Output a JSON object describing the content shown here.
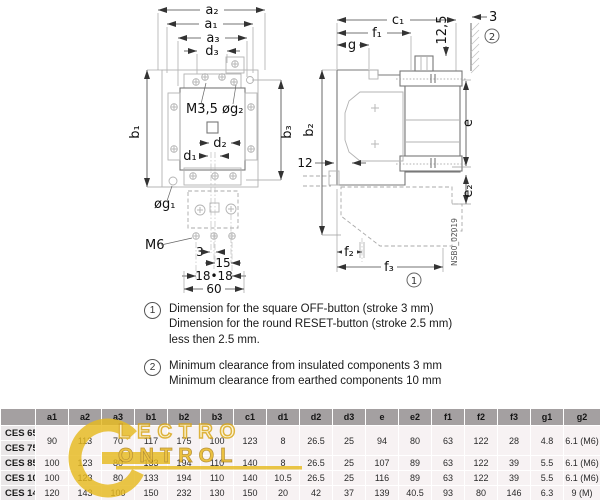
{
  "drawing": {
    "front": {
      "a2": "a₂",
      "a1": "a₁",
      "a3": "a₃",
      "d3": "d₃",
      "b1": "b₁",
      "b3": "b₃",
      "m35": "M3,5 øg₂",
      "d2": "d₂",
      "d1": "d₁",
      "og1": "øg₁",
      "m6": "M6",
      "dim3": "3",
      "dim15": "15",
      "dim1818": "18•18",
      "dim60": "60"
    },
    "side": {
      "c1": "c₁",
      "f1": "f₁",
      "g": "g",
      "dim125": "12,5",
      "dim3": "3",
      "b2": "b₂",
      "dim12": "12",
      "e": "e",
      "e2": "e₂",
      "f2": "f₂",
      "f3": "f₃",
      "code": "NSB0_02019",
      "callout1": "1",
      "callout2": "2"
    }
  },
  "notes": [
    {
      "num": "1",
      "lines": [
        "Dimension for the square OFF-button (stroke 3 mm)",
        "Dimension for the round RESET-button (stroke 2.5 mm)",
        "less then 2.5 mm."
      ]
    },
    {
      "num": "2",
      "lines": [
        "Minimum clearance from insulated components 3 mm",
        "Minimum clearance from earthed components 10 mm"
      ]
    }
  ],
  "table": {
    "columns": [
      "a1",
      "a2",
      "a3",
      "b1",
      "b2",
      "b3",
      "c1",
      "d1",
      "d2",
      "d3",
      "e",
      "e2",
      "f1",
      "f2",
      "f3",
      "g1",
      "g2"
    ],
    "rows": [
      {
        "label": "CES 65",
        "rowspan": 2,
        "values": [
          "90",
          "113",
          "70",
          "117",
          "175",
          "100",
          "123",
          "8",
          "26.5",
          "25",
          "94",
          "80",
          "63",
          "122",
          "28",
          "4.8",
          "6.1 (M6)"
        ]
      },
      {
        "label": "CES 75"
      },
      {
        "label": "CES 85",
        "rowspan": 1,
        "values": [
          "100",
          "123",
          "80",
          "133",
          "194",
          "110",
          "140",
          "8",
          "26.5",
          "25",
          "107",
          "89",
          "63",
          "122",
          "39",
          "5.5",
          "6.1 (M6)"
        ]
      },
      {
        "label": "CES 105",
        "rowspan": 1,
        "values": [
          "100",
          "123",
          "80",
          "133",
          "194",
          "110",
          "140",
          "10.5",
          "26.5",
          "25",
          "116",
          "89",
          "63",
          "122",
          "39",
          "5.5",
          "6.1 (M6)"
        ]
      },
      {
        "label": "CES 140",
        "rowspan": 1,
        "values": [
          "120",
          "143",
          "100",
          "150",
          "232",
          "130",
          "150",
          "20",
          "42",
          "37",
          "139",
          "40.5",
          "93",
          "80",
          "146",
          "6.3",
          "9 (M)"
        ]
      }
    ]
  },
  "watermark": {
    "top": "LECTRO",
    "bottom": "ONTROL",
    "color": "#e7ba20"
  }
}
